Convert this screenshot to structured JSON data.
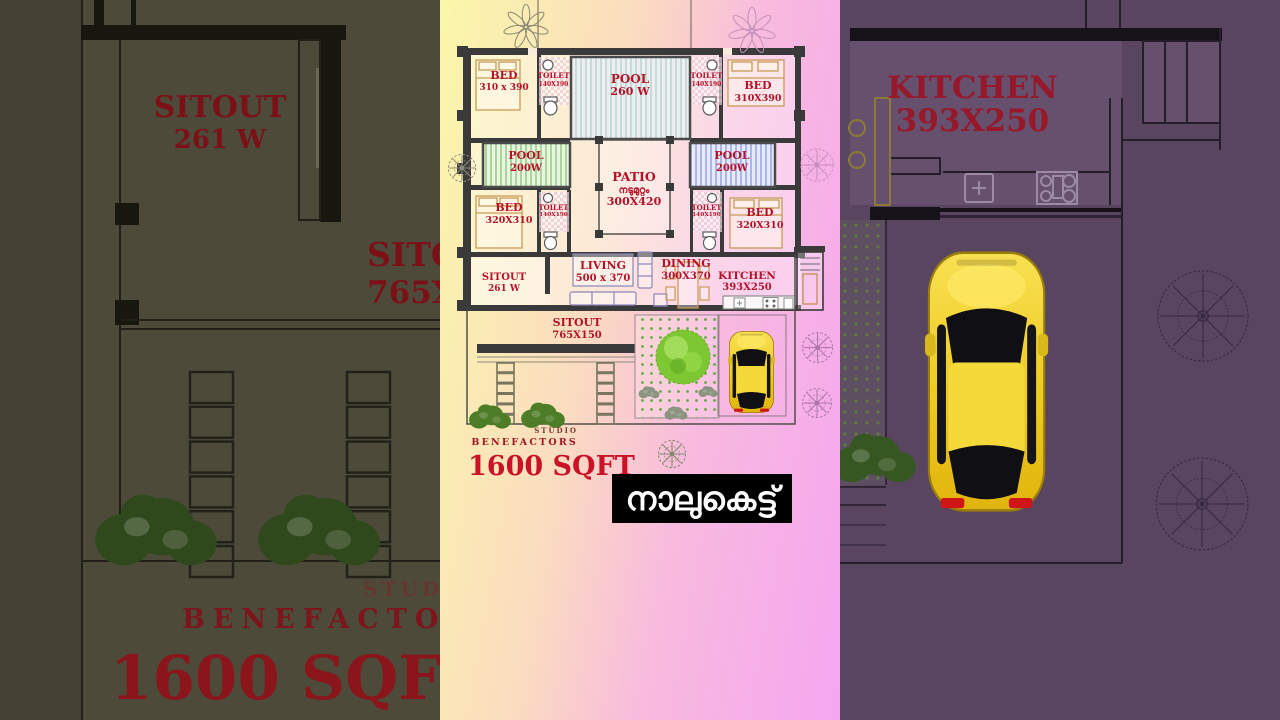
{
  "overlay": {
    "title": "നാലുകെട്ട്"
  },
  "branding": {
    "studio": "STUDIO",
    "name": "BENEFACTORS",
    "area": "1600 SQFT"
  },
  "plan": {
    "rooms": {
      "bed_tl": {
        "name": "BED",
        "dims": "310 x 390"
      },
      "toilet_tl": {
        "name": "TOILET",
        "dims": "140X190"
      },
      "pool_top": {
        "name": "POOL",
        "dims": "260 W"
      },
      "toilet_tr": {
        "name": "TOILET",
        "dims": "140X190"
      },
      "bed_tr": {
        "name": "BED",
        "dims": "310X390"
      },
      "pool_left": {
        "name": "POOL",
        "dims": "200W"
      },
      "patio": {
        "name": "PATIO",
        "malayalam": "നടുമുറ്റം",
        "dims": "300X420"
      },
      "pool_right": {
        "name": "POOL",
        "dims": "200W"
      },
      "bed_bl": {
        "name": "BED",
        "dims": "320X310"
      },
      "toilet_bl": {
        "name": "TOILET",
        "dims": "140X190"
      },
      "toilet_br": {
        "name": "TOILET",
        "dims": "140X190"
      },
      "bed_br": {
        "name": "BED",
        "dims": "320X310"
      },
      "sitout_side": {
        "name": "SITOUT",
        "dims": "261 W"
      },
      "living": {
        "name": "LIVING",
        "dims": "500 x 370"
      },
      "dining": {
        "name": "DINING",
        "dims": "300X370"
      },
      "kitchen": {
        "name": "KITCHEN",
        "dims": "393X250"
      },
      "sitout_front": {
        "name": "SITOUT",
        "dims": "765X150"
      }
    }
  },
  "colors": {
    "label_red": "#b5122a",
    "area_red": "#cb1126",
    "brand_red": "#a51523",
    "banner_bg": "#000000",
    "banner_fg": "#ffffff",
    "car_yellow": "#f0cc20",
    "tree_green": "#7dc832",
    "pool_teal_stripe": "#bfdfd8",
    "pool_green_stripe": "#a8d698",
    "pool_blue_stripe": "#aab6ea"
  }
}
